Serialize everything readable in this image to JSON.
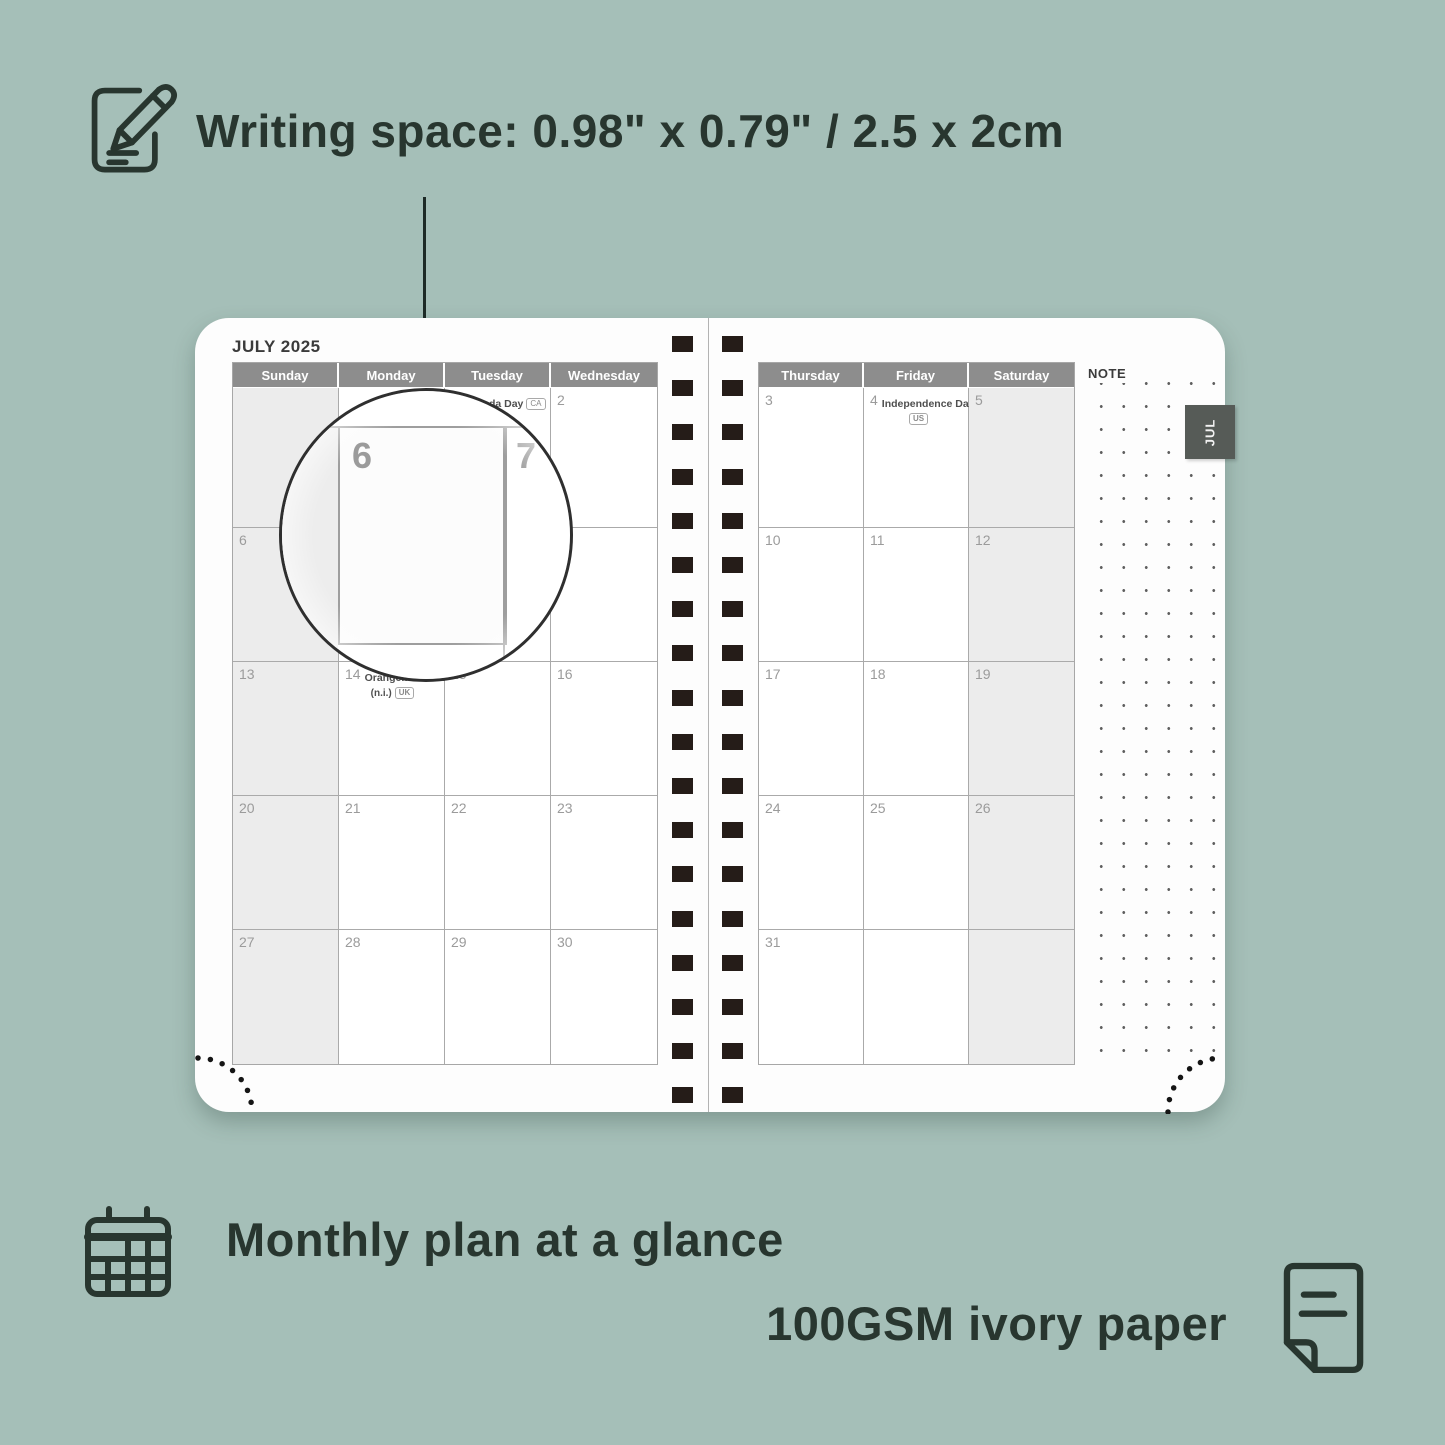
{
  "annotations": {
    "writing_space": "Writing space: 0.98\" x 0.79\" / 2.5 x 2cm",
    "monthly_plan": "Monthly plan at a glance",
    "paper": "100GSM ivory paper"
  },
  "planner": {
    "month_title": "JULY 2025",
    "note_label": "NOTE",
    "month_tab": "JUL",
    "magnifier": {
      "left_label": "6",
      "right_label": "7"
    },
    "left_page": {
      "day_headers": [
        "Sunday",
        "Monday",
        "Tuesday",
        "Wednesday"
      ],
      "shaded_col": 0,
      "rows": [
        [
          {
            "d": ""
          },
          {
            "d": ""
          },
          {
            "d": "1",
            "holiday": "Canada Day",
            "badge": "CA",
            "inline_badge": true
          },
          {
            "d": "2"
          }
        ],
        [
          {
            "d": "6"
          },
          {
            "d": "7"
          },
          {
            "d": "8"
          },
          {
            "d": "9"
          }
        ],
        [
          {
            "d": "13"
          },
          {
            "d": "14",
            "holiday": "Orangemen's Day",
            "line2": "(n.i.)",
            "badge": "UK"
          },
          {
            "d": "15"
          },
          {
            "d": "16"
          }
        ],
        [
          {
            "d": "20"
          },
          {
            "d": "21"
          },
          {
            "d": "22"
          },
          {
            "d": "23"
          }
        ],
        [
          {
            "d": "27"
          },
          {
            "d": "28"
          },
          {
            "d": "29"
          },
          {
            "d": "30"
          }
        ]
      ]
    },
    "right_page": {
      "day_headers": [
        "Thursday",
        "Friday",
        "Saturday"
      ],
      "shaded_col": 2,
      "rows": [
        [
          {
            "d": "3"
          },
          {
            "d": "4",
            "holiday": "Independence Day",
            "badge": "US"
          },
          {
            "d": "5"
          }
        ],
        [
          {
            "d": "10"
          },
          {
            "d": "11"
          },
          {
            "d": "12"
          }
        ],
        [
          {
            "d": "17"
          },
          {
            "d": "18"
          },
          {
            "d": "19"
          }
        ],
        [
          {
            "d": "24"
          },
          {
            "d": "25"
          },
          {
            "d": "26"
          }
        ],
        [
          {
            "d": "31"
          },
          {
            "d": ""
          },
          {
            "d": ""
          }
        ]
      ]
    }
  },
  "colors": {
    "background": "#a5bfb8",
    "ink": "#28362f",
    "header_gray": "#8d8d8d",
    "shaded_cell": "#ececec",
    "grid_line": "#aaaaaa",
    "date_gray": "#9b9b9b",
    "spiral_square": "#251c18",
    "tab_bg": "#565b57"
  }
}
